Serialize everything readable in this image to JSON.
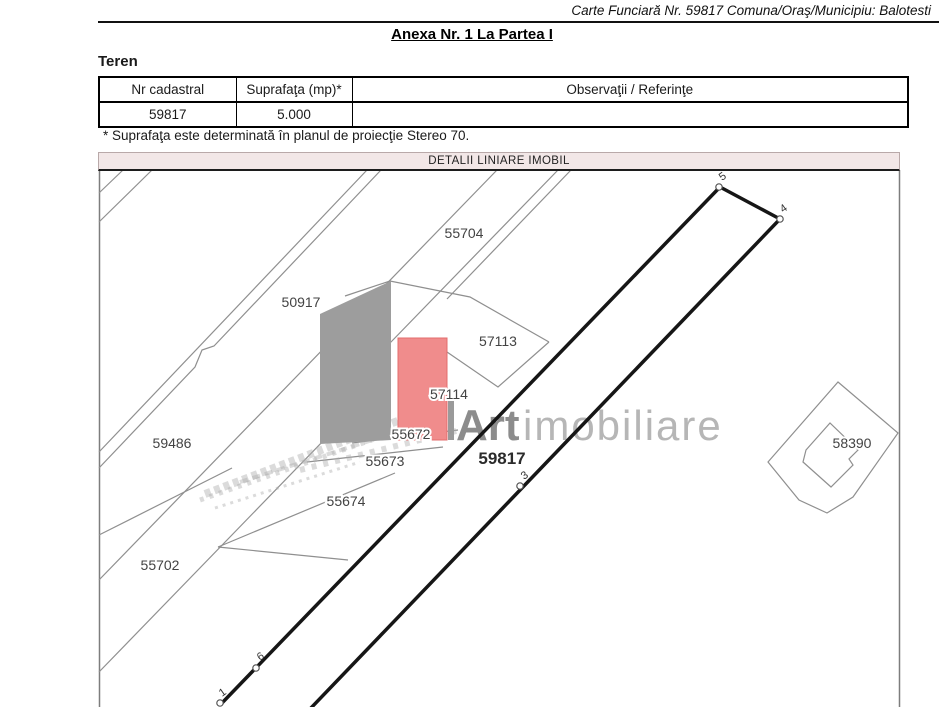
{
  "header": {
    "carte_funciara": "Carte Funciară Nr. 59817 Comuna/Oraş/Municipiu: Balotesti",
    "anexa_title": "Anexa Nr. 1 La Partea I",
    "section_title": "Teren"
  },
  "table": {
    "headers": [
      "Nr cadastral",
      "Suprafaţa (mp)*",
      "Observaţii / Referinţe"
    ],
    "rows": [
      [
        "59817",
        "5.000",
        ""
      ]
    ]
  },
  "footnote": "* Suprafaţa este determinată în planul de proiecţie Stereo 70.",
  "map": {
    "title": "DETALII LINIARE IMOBIL",
    "highlight_parcel": "59817",
    "watermark": {
      "bold": "Art",
      "light": "imobiliare"
    },
    "colors": {
      "highlight_fill": "#f08c8c",
      "building_fill": "#9d9d9d",
      "thin_line": "#8f8f8f",
      "boundary_line": "#161616",
      "bar_background": "#f2e7e7"
    },
    "parcel_labels": [
      {
        "id": "55704",
        "x": 464,
        "y": 238
      },
      {
        "id": "50917",
        "x": 301,
        "y": 307
      },
      {
        "id": "57113",
        "x": 498,
        "y": 346
      },
      {
        "id": "57114",
        "x": 449,
        "y": 399
      },
      {
        "id": "55672",
        "x": 411,
        "y": 439
      },
      {
        "id": "55673",
        "x": 385,
        "y": 466
      },
      {
        "id": "55674",
        "x": 346,
        "y": 506
      },
      {
        "id": "59486",
        "x": 172,
        "y": 448
      },
      {
        "id": "55702",
        "x": 160,
        "y": 570
      },
      {
        "id": "58390",
        "x": 852,
        "y": 448
      },
      {
        "id": "59817",
        "x": 502,
        "y": 464,
        "big": true
      }
    ],
    "vertices": [
      {
        "n": "5",
        "cx": 719,
        "cy": 187,
        "lx": 722,
        "ly": 181
      },
      {
        "n": "4",
        "cx": 780,
        "cy": 219,
        "lx": 783,
        "ly": 213
      },
      {
        "n": "3",
        "cx": 520,
        "cy": 486,
        "lx": 524,
        "ly": 480
      },
      {
        "n": "6",
        "cx": 256,
        "cy": 668,
        "lx": 260,
        "ly": 661
      },
      {
        "n": "1",
        "cx": 220,
        "cy": 703,
        "lx": 222,
        "ly": 697
      }
    ]
  }
}
